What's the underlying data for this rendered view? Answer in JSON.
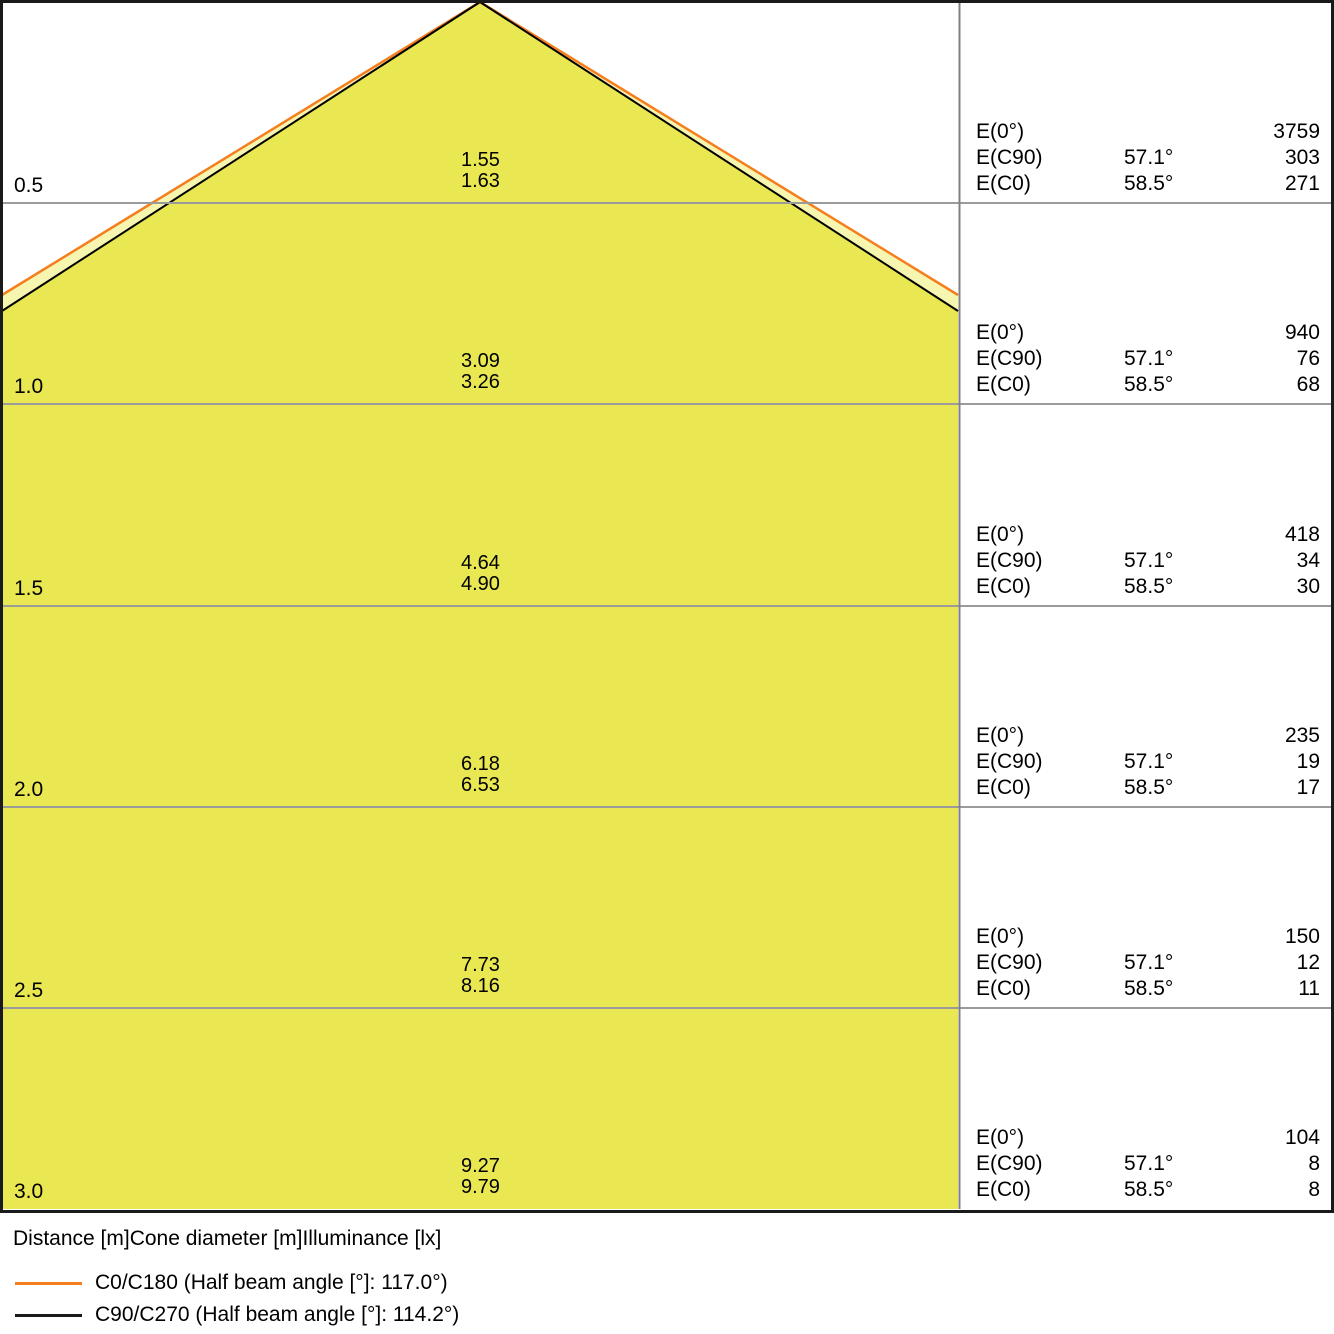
{
  "chart_data": {
    "type": "table",
    "title": "",
    "columns": [
      "Distance [m]",
      "Cone diameter [m]",
      "Illuminance [lx]"
    ],
    "distances_m": [
      0.5,
      1.0,
      1.5,
      2.0,
      2.5,
      3.0
    ],
    "series": [
      {
        "name": "C0/C180",
        "half_beam_angle_deg": 117.0,
        "color": "#f57e1f",
        "cone_diameters_m": [
          1.63,
          3.26,
          4.9,
          6.53,
          8.16,
          9.79
        ]
      },
      {
        "name": "C90/C270",
        "half_beam_angle_deg": 114.2,
        "color": "#1a1a1a",
        "cone_diameters_m": [
          1.55,
          3.09,
          4.64,
          6.18,
          7.73,
          9.27
        ]
      }
    ],
    "illuminance_lx": {
      "E0_deg": {
        "label": "E(0°)",
        "values": [
          3759,
          940,
          418,
          235,
          150,
          104
        ]
      },
      "EC90": {
        "label": "E(C90)",
        "angle": "57.1°",
        "values": [
          303,
          76,
          34,
          19,
          12,
          8
        ]
      },
      "EC0": {
        "label": "E(C0)",
        "angle": "58.5°",
        "values": [
          271,
          68,
          30,
          17,
          11,
          8
        ]
      }
    },
    "legend_position": "bottom-left",
    "grid": true
  },
  "table_labels": {
    "e0": "E(0°)",
    "ec90": "E(C90)",
    "ec0": "E(C0)",
    "ec90_angle": "57.1°",
    "ec0_angle": "58.5°"
  },
  "rows": [
    {
      "distance": "0.5",
      "d_c90": "1.55",
      "d_c0": "1.63",
      "e0": "3759",
      "ec90": "303",
      "ec0": "271"
    },
    {
      "distance": "1.0",
      "d_c90": "3.09",
      "d_c0": "3.26",
      "e0": "940",
      "ec90": "76",
      "ec0": "68"
    },
    {
      "distance": "1.5",
      "d_c90": "4.64",
      "d_c0": "4.90",
      "e0": "418",
      "ec90": "34",
      "ec0": "30"
    },
    {
      "distance": "2.0",
      "d_c90": "6.18",
      "d_c0": "6.53",
      "e0": "235",
      "ec90": "19",
      "ec0": "17"
    },
    {
      "distance": "2.5",
      "d_c90": "7.73",
      "d_c0": "8.16",
      "e0": "150",
      "ec90": "12",
      "ec0": "11"
    },
    {
      "distance": "3.0",
      "d_c90": "9.27",
      "d_c0": "9.79",
      "e0": "104",
      "ec90": "8",
      "ec0": "8"
    }
  ],
  "axis_labels": {
    "distance": "Distance [m]",
    "cone_diameter": "Cone diameter [m]",
    "illuminance": "Illuminance [lx]"
  },
  "legend": {
    "c0": {
      "label": "C0/C180 (Half beam angle [°]: 117.0°)",
      "color": "#f57e1f"
    },
    "c90": {
      "label": "C90/C270 (Half beam angle [°]: 114.2°)",
      "color": "#1a1a1a"
    }
  },
  "colors": {
    "cone_fill_inner": "#e9e852",
    "cone_fill_outer": "#f6f6b0",
    "gridline": "#9b9b9b",
    "divider": "#808080",
    "border": "#1a1a1a"
  }
}
